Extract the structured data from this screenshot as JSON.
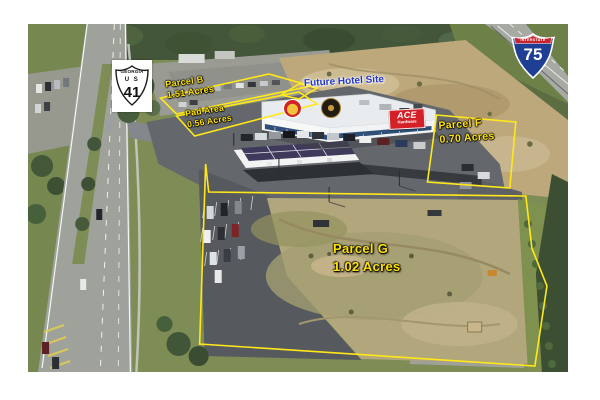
{
  "shields": {
    "us41": {
      "state": "GEORGIA",
      "designation": "U S",
      "number": "41"
    },
    "i75": {
      "banner": "INTERSTATE",
      "number": "75"
    }
  },
  "parcels": {
    "parcel_b": {
      "name": "Parcel B",
      "acreage": "1.51 Acres"
    },
    "pad_area": {
      "name": "Pad Area",
      "acreage": "0.56 Acres"
    },
    "future_hotel_site": {
      "label": "Future Hotel Site"
    },
    "parcel_f": {
      "name": "Parcel F",
      "acreage": "0.70 Acres"
    },
    "parcel_g": {
      "name": "Parcel G",
      "acreage": "1.02 Acres"
    }
  },
  "building_signage": {
    "ace": {
      "line1": "ACE",
      "line2": "Hardware"
    }
  },
  "colors": {
    "annotation_yellow": "#ffe81a",
    "hotel_label_blue": "#2438c8",
    "ace_sign_red": "#d42027",
    "interstate_blue": "#1e3f94",
    "interstate_red": "#c8252c"
  }
}
